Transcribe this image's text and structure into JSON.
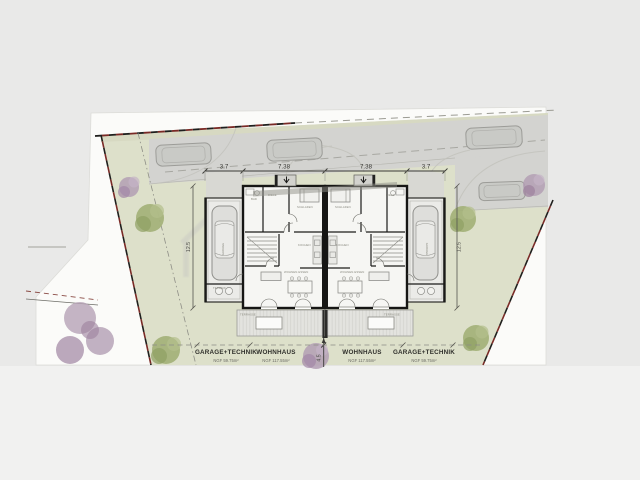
{
  "plan": {
    "dimensions": {
      "top": [
        "3.7",
        "7.38",
        "7.38",
        "3.7"
      ],
      "side_left": "12.5",
      "side_right": "12.5",
      "terrace_depth": "4.5"
    },
    "labels": {
      "garage_left": "GARAGE+TECHNIK",
      "house_left": "WOHNHAUS",
      "house_right": "WOHNHAUS",
      "garage_right": "GARAGE+TECHNIK",
      "garage_left_area": "NGF 59.75m²",
      "house_left_area": "NGF 117.55m²",
      "house_right_area": "NGF 117.55m²",
      "garage_right_area": "NGF 59.75m²"
    },
    "rooms": {
      "garage": "GARAGE",
      "technik": "TECHNIK",
      "bad": "BAD",
      "diele": "DIELE",
      "schlafen": "SCHLAFEN",
      "kochen": "KOCHEN",
      "wohnen": "WOHNEN·ESSEN",
      "terrasse": "TERRASSE"
    },
    "watermark": {
      "line1": "Immo",
      "line2": "Group"
    },
    "colors": {
      "background": "#e9e9e8",
      "page": "#fbfbf9",
      "garden": "#dde0ca",
      "road": "#d3d3d0",
      "wall": "#161616",
      "boundary_red": "#7a2a26",
      "tree_green": "#9aa96e",
      "tree_purple": "#b09ab2"
    }
  }
}
